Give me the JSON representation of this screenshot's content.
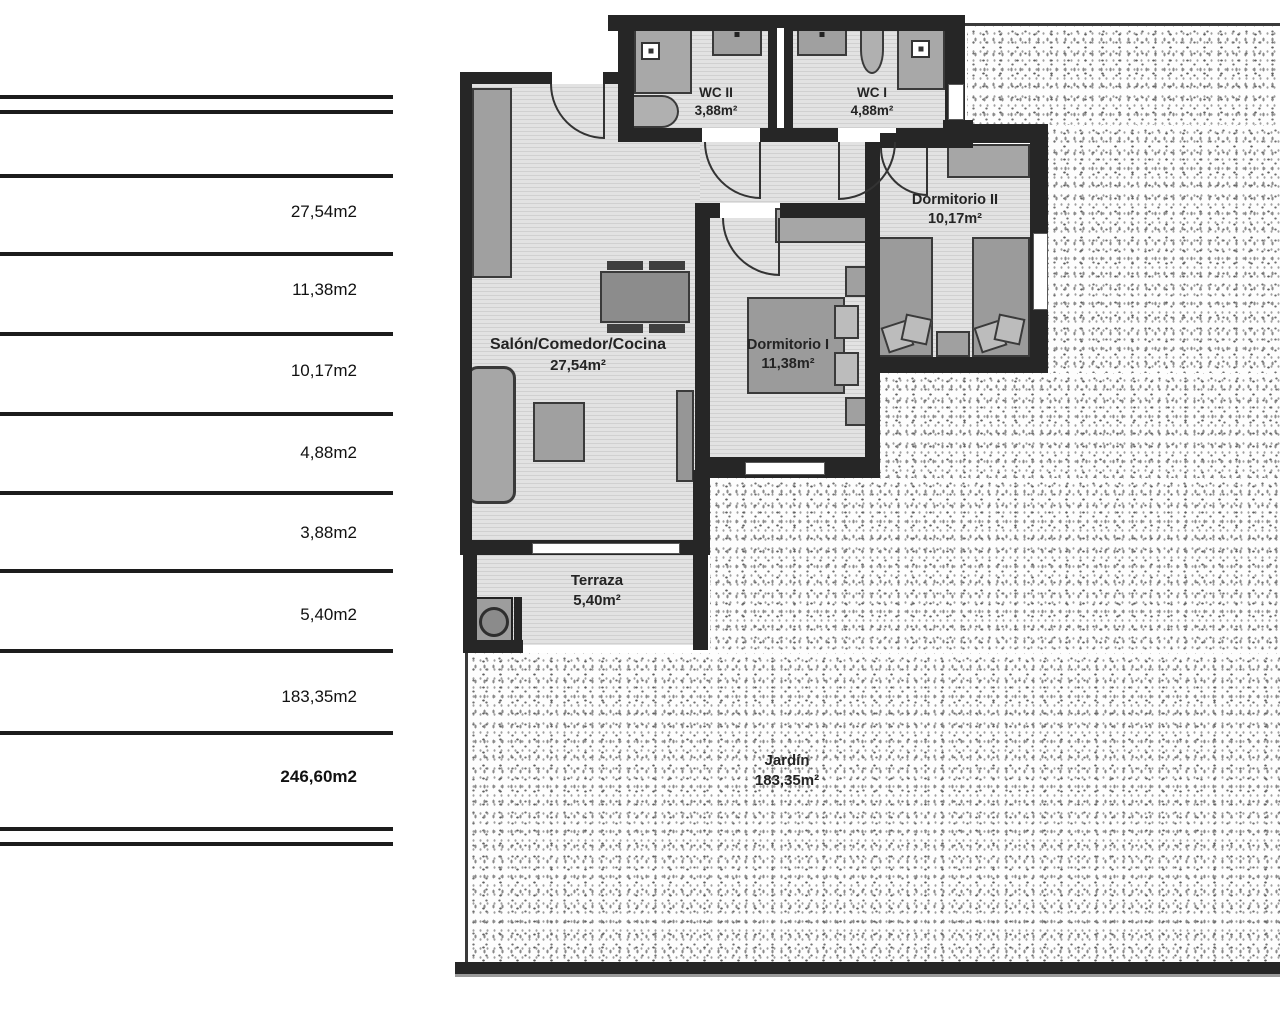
{
  "area_table": {
    "rows": [
      {
        "value": "27,54m2"
      },
      {
        "value": "11,38m2"
      },
      {
        "value": "10,17m2"
      },
      {
        "value": "4,88m2"
      },
      {
        "value": "3,88m2"
      },
      {
        "value": "5,40m2"
      },
      {
        "value": "183,35m2"
      },
      {
        "value": "246,60m2"
      }
    ]
  },
  "floorplan": {
    "rooms": [
      {
        "name": "WC II",
        "area": "3,88m²"
      },
      {
        "name": "WC I",
        "area": "4,88m²"
      },
      {
        "name": "Dormitorio II",
        "area": "10,17m²"
      },
      {
        "name": "Salón/Comedor/Cocina",
        "area": "27,54m²"
      },
      {
        "name": "Dormitorio I",
        "area": "11,38m²"
      },
      {
        "name": "Terraza",
        "area": "5,40m²"
      },
      {
        "name": "Jardín",
        "area": "183,35m²"
      }
    ]
  }
}
